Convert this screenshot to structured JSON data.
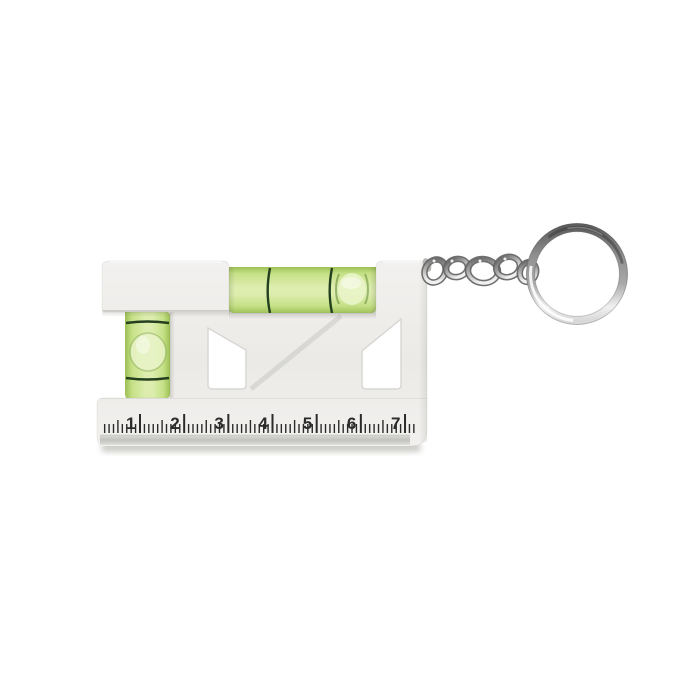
{
  "palette": {
    "background": "#ffffff",
    "body": "#f2f1ef",
    "body_mid": "#ebeae7",
    "body_shade": "#dddcd8",
    "body_edge": "#d2d1cd",
    "vial_green_dark": "#9cbf55",
    "vial_green": "#c6e187",
    "vial_green_light": "#dcedae",
    "vial_bubble": "#e9f4c8",
    "vial_line": "#24401f",
    "ruler_ink": "#2b2b2b",
    "strip_light": "#dadad7",
    "strip_mid": "#c2c2bf",
    "chrome_dark": "#5e5e5e",
    "chrome_mid": "#a8a8a8",
    "chrome_light": "#f1f1f1"
  },
  "ruler": {
    "unit_labels": [
      "1",
      "2",
      "3",
      "4",
      "5",
      "6",
      "7"
    ],
    "minor_per_unit": 10,
    "leading_minor": 8,
    "trailing_minor": 2
  }
}
